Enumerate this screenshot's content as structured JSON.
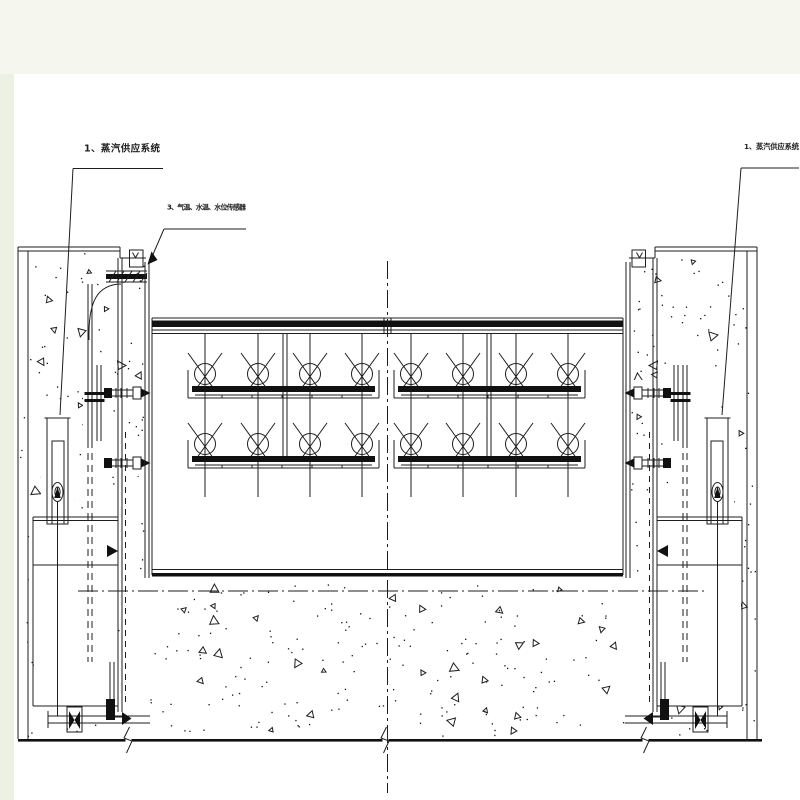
{
  "labels": {
    "steam_supply_left": {
      "text": "1、蒸汽供应系统"
    },
    "steam_supply_right": {
      "text": "1、蒸汽供应系统"
    },
    "sensors": {
      "text": "3、气温、水温、水位传感器"
    }
  },
  "colors": {
    "line": "#1e1e1e",
    "ink": "#111111",
    "paper": "#ffffff",
    "margin": "#edf1e3",
    "band": "#f5f7ee"
  },
  "figure": {
    "centerline_x": 387.5,
    "heater_columns_x": [
      205,
      258,
      310,
      362,
      411,
      463,
      516,
      568
    ],
    "heater_rows": [
      {
        "circle_y": 374,
        "pipe_y": 386
      },
      {
        "circle_y": 444,
        "pipe_y": 456
      }
    ],
    "pipe_run_starts_x": [
      192,
      398
    ],
    "rod_top_y": 334,
    "rod_bottom_y": 497
  },
  "texture": {
    "regions": [
      {
        "x": 20,
        "y": 253,
        "w": 104,
        "h": 484,
        "dots": 95,
        "tris": 10
      },
      {
        "x": 127,
        "y": 262,
        "w": 17,
        "h": 310,
        "dots": 22,
        "tris": 2
      },
      {
        "x": 651,
        "y": 253,
        "w": 104,
        "h": 484,
        "dots": 95,
        "tris": 10
      },
      {
        "x": 631,
        "y": 262,
        "w": 17,
        "h": 310,
        "dots": 22,
        "tris": 2
      },
      {
        "x": 150,
        "y": 584,
        "w": 476,
        "h": 152,
        "dots": 170,
        "tris": 30
      }
    ]
  }
}
